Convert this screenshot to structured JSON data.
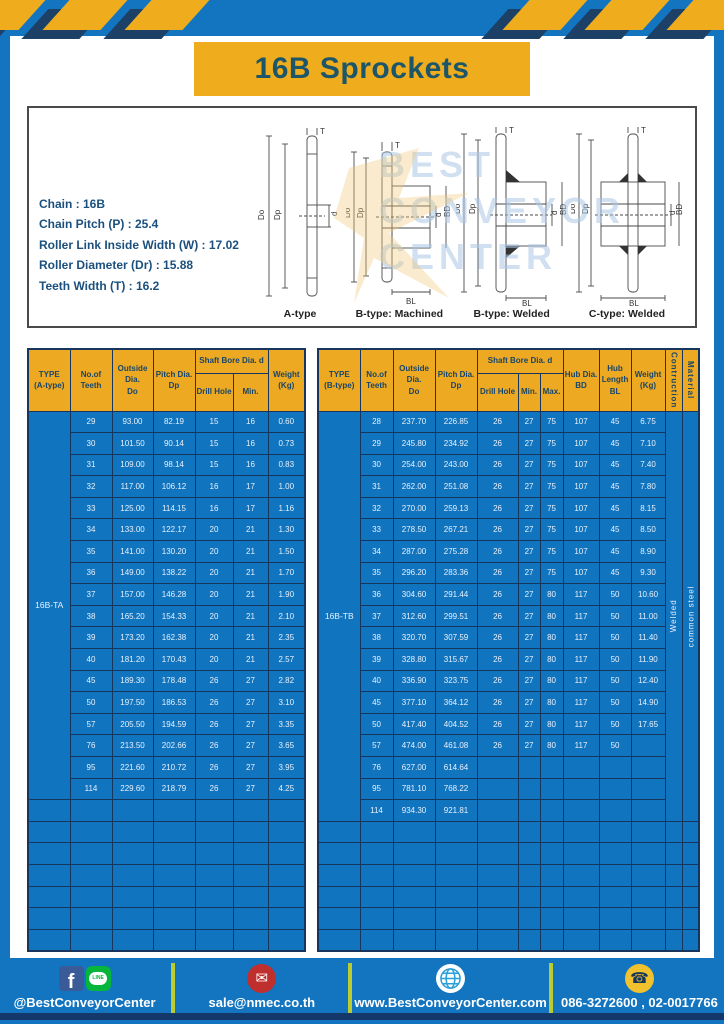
{
  "title": "16B Sprockets",
  "colors": {
    "frame_blue": "#1375c0",
    "table_blue": "#1174bf",
    "header_yellow": "#eca921",
    "banner_yellow": "#efad1e",
    "navy": "#16365e",
    "divider_green": "#b9cc31",
    "title_text": "#1d5668"
  },
  "specs": {
    "lines": [
      "Chain  :  16B",
      "Chain Pitch (P)  :  25.4",
      "Roller Link Inside Width (W) :  17.02",
      "Roller Diameter (Dr) : 15.88",
      "Teeth Width (T)  :  16.2"
    ]
  },
  "watermark": {
    "lines": [
      "BEST",
      "CONVEYOR",
      "CENTER"
    ]
  },
  "diagrams": {
    "captions": [
      "A-type",
      "B-type: Machined",
      "B-type: Welded",
      "C-type: Welded"
    ],
    "dim_labels": {
      "t": "T",
      "do": "Do",
      "dp": "Dp",
      "d": "d",
      "bd": "BD",
      "bl": "BL"
    }
  },
  "table_a": {
    "type_label": "16B-TA",
    "headers": {
      "type": "TYPE\n(A-type)",
      "teeth": "No.of\nTeeth",
      "outside": "Outside\nDia.\nDo",
      "pitch": "Pitch Dia.\nDp",
      "shaft": "Shaft Bore Dia. d",
      "drill": "Drill Hole",
      "min": "Min.",
      "weight": "Weight\n(Kg)"
    },
    "rows": [
      [
        "29",
        "93.00",
        "82.19",
        "15",
        "16",
        "0.60"
      ],
      [
        "30",
        "101.50",
        "90.14",
        "15",
        "16",
        "0.73"
      ],
      [
        "31",
        "109.00",
        "98.14",
        "15",
        "16",
        "0.83"
      ],
      [
        "32",
        "117.00",
        "106.12",
        "16",
        "17",
        "1.00"
      ],
      [
        "33",
        "125.00",
        "114.15",
        "16",
        "17",
        "1.16"
      ],
      [
        "34",
        "133.00",
        "122.17",
        "20",
        "21",
        "1.30"
      ],
      [
        "35",
        "141.00",
        "130.20",
        "20",
        "21",
        "1.50"
      ],
      [
        "36",
        "149.00",
        "138.22",
        "20",
        "21",
        "1.70"
      ],
      [
        "37",
        "157.00",
        "146.28",
        "20",
        "21",
        "1.90"
      ],
      [
        "38",
        "165.20",
        "154.33",
        "20",
        "21",
        "2.10"
      ],
      [
        "39",
        "173.20",
        "162.38",
        "20",
        "21",
        "2.35"
      ],
      [
        "40",
        "181.20",
        "170.43",
        "20",
        "21",
        "2.57"
      ],
      [
        "45",
        "189.30",
        "178.48",
        "26",
        "27",
        "2.82"
      ],
      [
        "50",
        "197.50",
        "186.53",
        "26",
        "27",
        "3.10"
      ],
      [
        "57",
        "205.50",
        "194.59",
        "26",
        "27",
        "3.35"
      ],
      [
        "76",
        "213.50",
        "202.66",
        "26",
        "27",
        "3.65"
      ],
      [
        "95",
        "221.60",
        "210.72",
        "26",
        "27",
        "3.95"
      ],
      [
        "114",
        "229.60",
        "218.79",
        "26",
        "27",
        "4.25"
      ]
    ],
    "empty_rows": 7
  },
  "table_b": {
    "type_label": "16B-TB",
    "headers": {
      "type": "TYPE\n(B-type)",
      "teeth": "No.of\nTeeth",
      "outside": "Outside\nDia.\nDo",
      "pitch": "Pitch Dia.\nDp",
      "shaft": "Shaft Bore Dia. d",
      "drill": "Drill Hole",
      "min": "Min.",
      "max": "Max.",
      "hub_dia": "Hub Dia.\nBD",
      "hub_len": "Hub\nLength\nBL",
      "weight": "Weight\n(Kg)",
      "construction": "Contruction",
      "material": "Material"
    },
    "construction": "Welded",
    "material": "common steel",
    "rows": [
      [
        "28",
        "237.70",
        "226.85",
        "26",
        "27",
        "75",
        "107",
        "45",
        "6.75"
      ],
      [
        "29",
        "245.80",
        "234.92",
        "26",
        "27",
        "75",
        "107",
        "45",
        "7.10"
      ],
      [
        "30",
        "254.00",
        "243.00",
        "26",
        "27",
        "75",
        "107",
        "45",
        "7.40"
      ],
      [
        "31",
        "262.00",
        "251.08",
        "26",
        "27",
        "75",
        "107",
        "45",
        "7.80"
      ],
      [
        "32",
        "270.00",
        "259.13",
        "26",
        "27",
        "75",
        "107",
        "45",
        "8.15"
      ],
      [
        "33",
        "278.50",
        "267.21",
        "26",
        "27",
        "75",
        "107",
        "45",
        "8.50"
      ],
      [
        "34",
        "287.00",
        "275.28",
        "26",
        "27",
        "75",
        "107",
        "45",
        "8.90"
      ],
      [
        "35",
        "296.20",
        "283.36",
        "26",
        "27",
        "75",
        "107",
        "45",
        "9.30"
      ],
      [
        "36",
        "304.60",
        "291.44",
        "26",
        "27",
        "80",
        "117",
        "50",
        "10.60"
      ],
      [
        "37",
        "312.60",
        "299.51",
        "26",
        "27",
        "80",
        "117",
        "50",
        "11.00"
      ],
      [
        "38",
        "320.70",
        "307.59",
        "26",
        "27",
        "80",
        "117",
        "50",
        "11.40"
      ],
      [
        "39",
        "328.80",
        "315.67",
        "26",
        "27",
        "80",
        "117",
        "50",
        "11.90"
      ],
      [
        "40",
        "336.90",
        "323.75",
        "26",
        "27",
        "80",
        "117",
        "50",
        "12.40"
      ],
      [
        "45",
        "377.10",
        "364.12",
        "26",
        "27",
        "80",
        "117",
        "50",
        "14.90"
      ],
      [
        "50",
        "417.40",
        "404.52",
        "26",
        "27",
        "80",
        "117",
        "50",
        "17.65"
      ],
      [
        "57",
        "474.00",
        "461.08",
        "26",
        "27",
        "80",
        "117",
        "50",
        ""
      ],
      [
        "76",
        "627.00",
        "614.64",
        "",
        "",
        "",
        "",
        "",
        ""
      ],
      [
        "95",
        "781.10",
        "768.22",
        "",
        "",
        "",
        "",
        "",
        ""
      ],
      [
        "114",
        "934.30",
        "921.81",
        "",
        "",
        "",
        "",
        "",
        ""
      ]
    ],
    "empty_rows": 6
  },
  "footer": {
    "items": [
      {
        "label": "@BestConveyorCenter"
      },
      {
        "label": "sale@nmec.co.th"
      },
      {
        "label": "www.BestConveyorCenter.com"
      },
      {
        "label": "086-3272600 , 02-0017766"
      }
    ],
    "line_icon_text": "LINE",
    "fb_letter": "f"
  }
}
